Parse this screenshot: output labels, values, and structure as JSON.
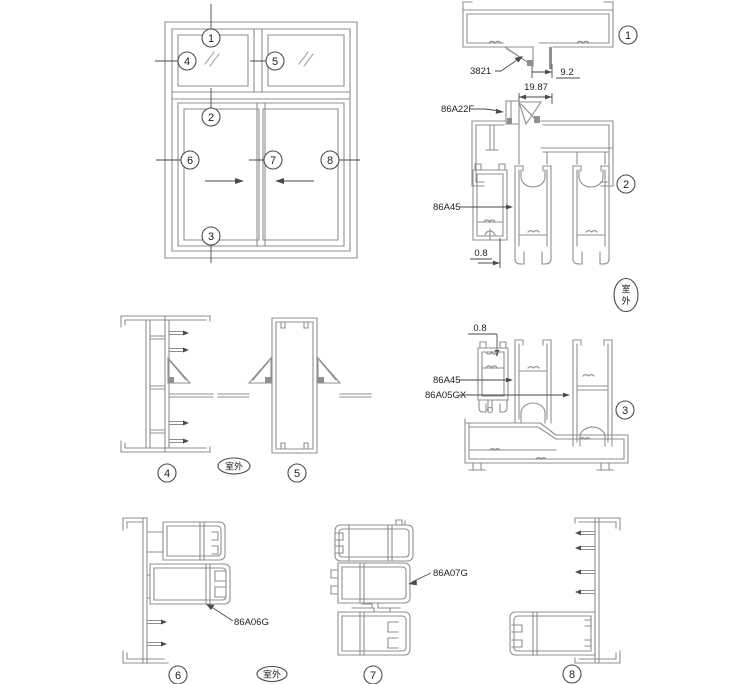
{
  "colors": {
    "line": "#8f8f8f",
    "dark": "#4a4a4a",
    "text": "#1e1e1e",
    "bg": "#ffffff"
  },
  "elevation": {
    "callouts": [
      "1",
      "2",
      "3",
      "4",
      "5",
      "6",
      "7",
      "8"
    ]
  },
  "sections": {
    "s1": {
      "num": "1",
      "part_label": "3821",
      "dim_offset": "9.2",
      "dim_pocket": "19.87"
    },
    "s2": {
      "num": "2",
      "bead_label": "86A22F",
      "track_label": "86A45",
      "dim_wall": "0.8"
    },
    "s3": {
      "num": "3",
      "dim_wall": "0.8",
      "track_label": "86A45",
      "sash_label": "86A05GX"
    },
    "s4": {
      "num": "4"
    },
    "s5": {
      "num": "5"
    },
    "s6": {
      "num": "6",
      "sash_label": "86A06G"
    },
    "s7": {
      "num": "7",
      "sash_label": "86A07G"
    },
    "s8": {
      "num": "8"
    }
  },
  "outdoor": {
    "label": "室外",
    "char1": "室",
    "char2": "外"
  }
}
